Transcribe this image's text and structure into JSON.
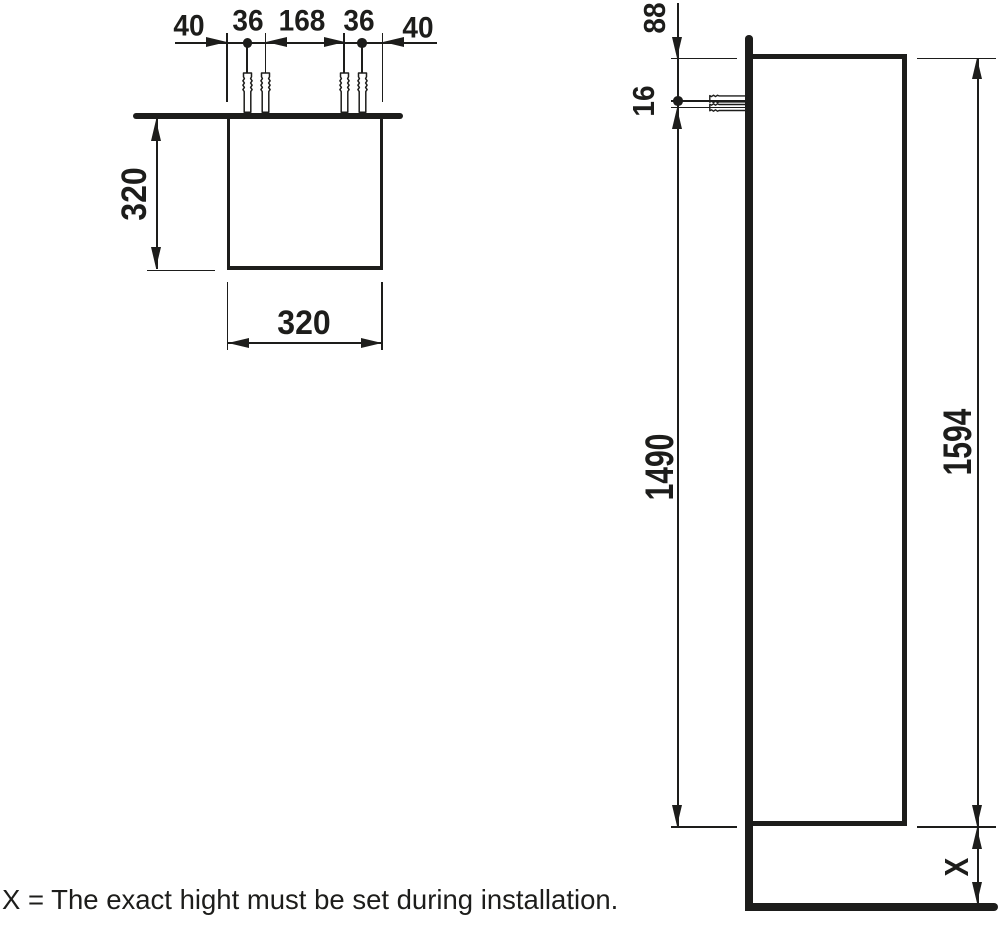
{
  "drawing": {
    "type": "technical-installation-drawing",
    "ink_color": "#1d1d1b",
    "background_color": "#ffffff",
    "note": "X = The exact hight must be set during installation.",
    "plan_view": {
      "hole_spacing_dims": [
        "40",
        "36",
        "168",
        "36",
        "40"
      ],
      "depth_dim": "320",
      "width_dim": "320",
      "wall_plug_icons": 4
    },
    "side_view": {
      "top_offset_dim": "88",
      "hole_gap_dim": "16",
      "holes_to_bottom_dim": "1490",
      "cabinet_height_dim": "1594",
      "floor_gap_dim": "X",
      "wall_plug_icons": 1
    }
  }
}
